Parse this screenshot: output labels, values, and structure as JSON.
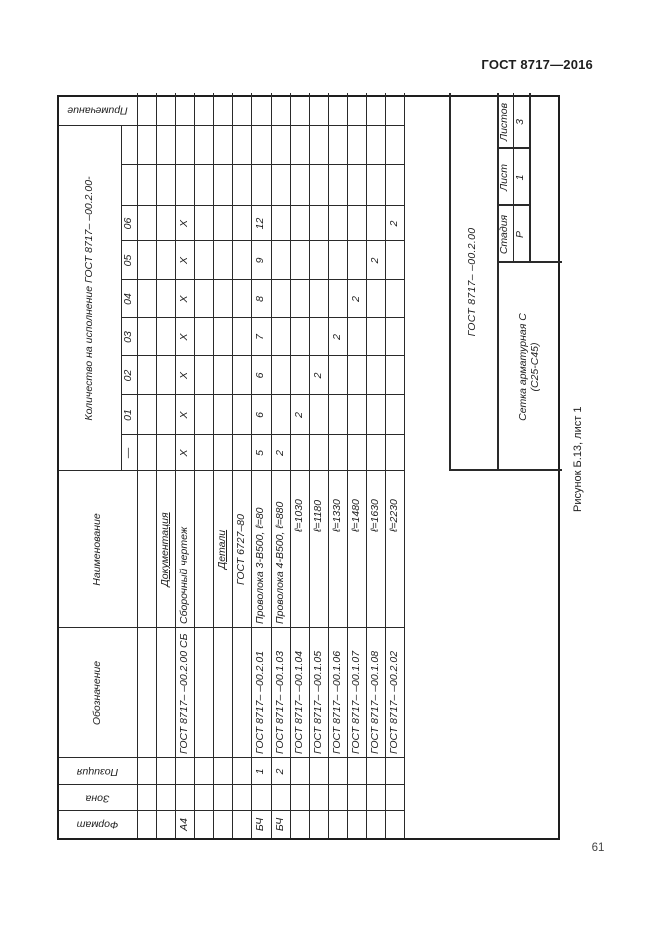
{
  "page": {
    "standard_ref": "ГОСТ 8717—2016",
    "figure_caption": "Рисунок Б.13, лист 1",
    "page_number": "61"
  },
  "table": {
    "headers": {
      "format": "Формат",
      "zone": "Зона",
      "position": "Позиция",
      "designation": "Обозначение",
      "name": "Наименование",
      "quantity_group": "Количество на исполнение ГОСТ 8717– –00.2.00-",
      "note": "Примечание",
      "executions": [
        "—",
        "01",
        "02",
        "03",
        "04",
        "05",
        "06",
        "",
        ""
      ]
    },
    "rows": [
      {
        "format": "",
        "zone": "",
        "position": "",
        "designation": "",
        "name": "",
        "style": "",
        "qty": [
          "",
          "",
          "",
          "",
          "",
          "",
          "",
          "",
          ""
        ],
        "note": ""
      },
      {
        "name": "Документация",
        "style": "section"
      },
      {
        "format": "А4",
        "designation": "ГОСТ 8717– –00.2.00 СБ",
        "name": "Сборочный чертеж",
        "qty": [
          "Х",
          "Х",
          "Х",
          "Х",
          "Х",
          "Х",
          "Х",
          "",
          ""
        ]
      },
      {},
      {
        "name": "Детали",
        "style": "section"
      },
      {
        "name": "ГОСТ 6727–80",
        "style": "center"
      },
      {
        "format": "БЧ",
        "position": "1",
        "designation": "ГОСТ 8717– –00.2.01",
        "name": "Проволока 3-В500, ℓ=80",
        "qty": [
          "5",
          "6",
          "6",
          "7",
          "8",
          "9",
          "12",
          "",
          ""
        ]
      },
      {
        "format": "БЧ",
        "position": "2",
        "designation": "ГОСТ 8717– –00.1.03",
        "name": "Проволока 4-В500, ℓ=880",
        "qty": [
          "2",
          "",
          "",
          "",
          "",
          "",
          "",
          "",
          ""
        ]
      },
      {
        "designation": "ГОСТ 8717– –00.1.04",
        "name": "ℓ=1030",
        "style": "indent",
        "qty": [
          "",
          "2",
          "",
          "",
          "",
          "",
          "",
          "",
          ""
        ]
      },
      {
        "designation": "ГОСТ 8717– –00.1.05",
        "name": "ℓ=1180",
        "style": "indent",
        "qty": [
          "",
          "",
          "2",
          "",
          "",
          "",
          "",
          "",
          ""
        ]
      },
      {
        "designation": "ГОСТ 8717– –00.1.06",
        "name": "ℓ=1330",
        "style": "indent",
        "qty": [
          "",
          "",
          "",
          "2",
          "",
          "",
          "",
          "",
          ""
        ]
      },
      {
        "designation": "ГОСТ 8717– –00.1.07",
        "name": "ℓ=1480",
        "style": "indent",
        "qty": [
          "",
          "",
          "",
          "",
          "2",
          "",
          "",
          "",
          ""
        ]
      },
      {
        "designation": "ГОСТ 8717– –00.1.08",
        "name": "ℓ=1630",
        "style": "indent",
        "qty": [
          "",
          "",
          "",
          "",
          "",
          "2",
          "",
          "",
          ""
        ]
      },
      {
        "designation": "ГОСТ 8717– –00.2.02",
        "name": "ℓ=2230",
        "style": "indent",
        "qty": [
          "",
          "",
          "",
          "",
          "",
          "",
          "2",
          "",
          ""
        ]
      }
    ],
    "title_block": {
      "designation": "ГОСТ 8717– –00.2.00",
      "product_name_line1": "Сетка арматурная С",
      "product_name_line2": "(С25-С45)",
      "stage_label": "Стадия",
      "sheet_label": "Лист",
      "sheets_label": "Листов",
      "stage_value": "Р",
      "sheet_value": "1",
      "sheets_value": "3"
    }
  }
}
